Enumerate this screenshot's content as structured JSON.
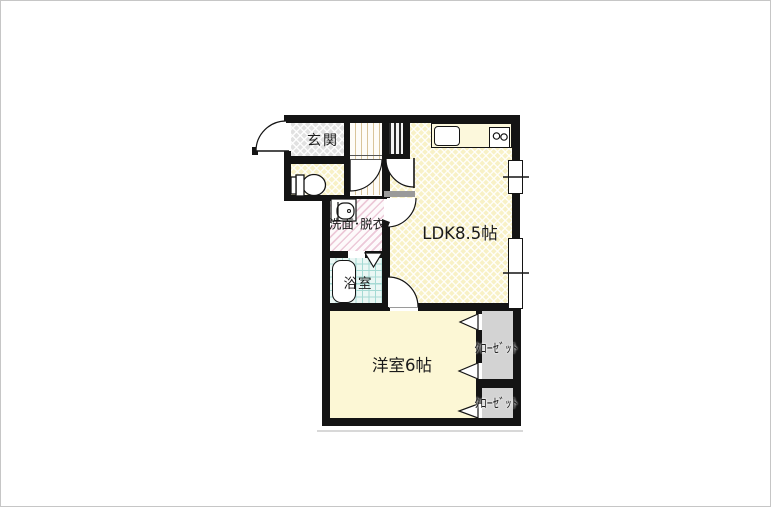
{
  "rooms": {
    "genkan": {
      "label": "玄関"
    },
    "washroom": {
      "label": "洗面･脱衣"
    },
    "bathroom": {
      "label": "浴室"
    },
    "ldk": {
      "label": "LDK8.5帖"
    },
    "bedroom": {
      "label": "洋室6帖"
    },
    "closet_upper": {
      "label": "ｸﾛｰｾﾞｯﾄ"
    },
    "closet_lower": {
      "label": "ｸﾛｰｾﾞｯﾄ"
    }
  },
  "colors": {
    "wall": "#141414",
    "floorYellow": "#f8f1c6",
    "genkanFloor": "#e1e1e1",
    "bedroomFloor": "#fcf7d5",
    "closetFloor": "#d3d3d3",
    "bathFloor": "#eaf7f4",
    "bathGrid": "#a5dad4",
    "washStripe": "#ecc9d8",
    "hallStripe": "#d9c49a",
    "threshold": "#9a9a9a"
  }
}
